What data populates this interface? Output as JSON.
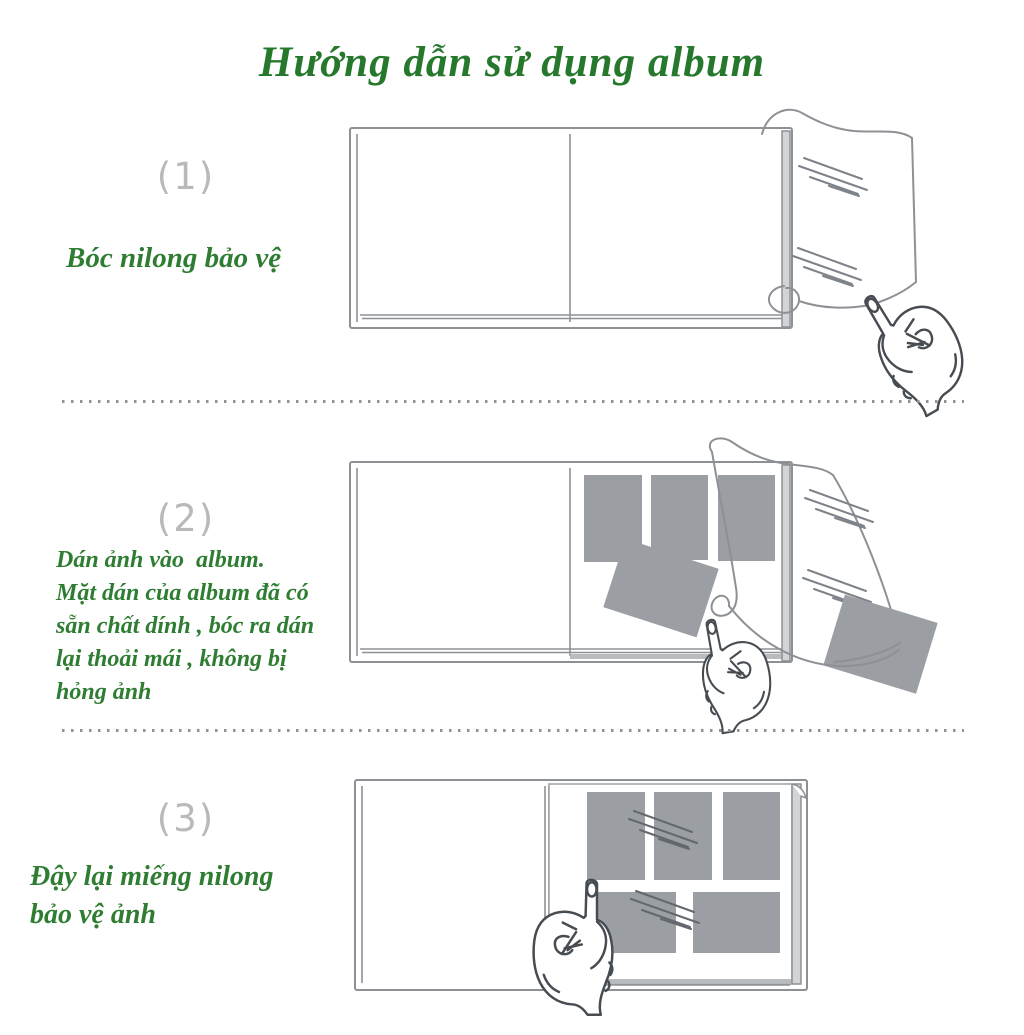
{
  "title": "Hướng dẫn sử dụng album",
  "steps": [
    {
      "number": "(1)",
      "caption": "Bóc nilong bảo vệ"
    },
    {
      "number": "(2)",
      "caption": "Dán ảnh vào  album.\nMặt dán của album đã có\nsẵn chất dính , bóc ra dán\nlại thoải mái , không bị\nhỏng ảnh"
    },
    {
      "number": "(3)",
      "caption": "Đậy lại miếng nilong\nbảo vệ ảnh"
    }
  ],
  "colors": {
    "title_green": "#26792c",
    "caption_green": "#2e7d32",
    "step_number_gray": "#b7b9bb",
    "line_art_gray": "#8d9196",
    "hand_line_gray": "#474c52",
    "photo_gray": "#9b9ea3",
    "divider_gray": "#8f9296",
    "background": "#ffffff"
  }
}
